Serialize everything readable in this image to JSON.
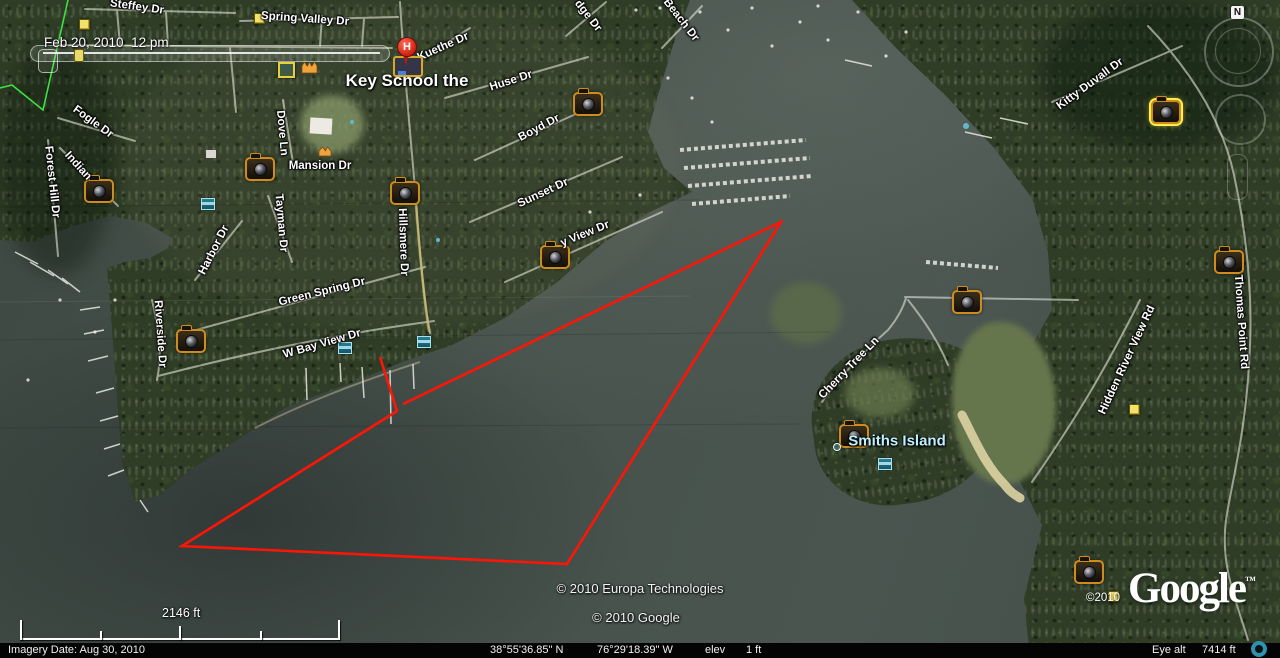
{
  "branding": {
    "logo_text": "Google",
    "tm": "™",
    "watermark": "©2010"
  },
  "time_display": {
    "date_label": "Feb 20, 2010  12 pm"
  },
  "status_bar": {
    "imagery_date": "Imagery Date: Aug 30, 2010",
    "latitude": "38°55'36.85\" N",
    "longitude": "76°29'18.39\" W",
    "elev_label": "elev",
    "elev_value": "1 ft",
    "eye_alt_label": "Eye alt",
    "eye_alt_value": "7414 ft"
  },
  "scale_bar": {
    "distance": "2146 ft"
  },
  "copyrights": {
    "line1": "© 2010 Europa Technologies",
    "line2": "© 2010 Google"
  },
  "compass": {
    "north_label": "N"
  },
  "map": {
    "place_labels": [
      {
        "text": "Key School the",
        "x": 407,
        "y": 81,
        "size": 17,
        "color": "#ffffff"
      },
      {
        "text": "Smiths Island",
        "x": 897,
        "y": 441,
        "size": 15,
        "color": "#bff2ff"
      }
    ],
    "street_labels": [
      {
        "text": "Steffey Dr",
        "x": 137,
        "y": 7,
        "rot": 8
      },
      {
        "text": "Spring Valley Dr",
        "x": 305,
        "y": 19,
        "rot": 4
      },
      {
        "text": "Fogle Dr",
        "x": 93,
        "y": 122,
        "rot": 36
      },
      {
        "text": "Forest Hill Dr",
        "x": 52,
        "y": 182,
        "rot": 84
      },
      {
        "text": "Indian",
        "x": 78,
        "y": 166,
        "rot": 48
      },
      {
        "text": "Dove Ln",
        "x": 282,
        "y": 133,
        "rot": 85
      },
      {
        "text": "Kuethe Dr",
        "x": 443,
        "y": 47,
        "rot": -24
      },
      {
        "text": "Huse Dr",
        "x": 511,
        "y": 81,
        "rot": -18
      },
      {
        "text": "Boyd Dr",
        "x": 539,
        "y": 128,
        "rot": -28
      },
      {
        "text": "Sunset Dr",
        "x": 543,
        "y": 193,
        "rot": -25
      },
      {
        "text": "y View Dr",
        "x": 585,
        "y": 234,
        "rot": -22
      },
      {
        "text": "Mansion Dr",
        "x": 320,
        "y": 166,
        "rot": 0
      },
      {
        "text": "Tayman Dr",
        "x": 281,
        "y": 223,
        "rot": 85
      },
      {
        "text": "Harbor Dr",
        "x": 214,
        "y": 250,
        "rot": -63
      },
      {
        "text": "Green Spring Dr",
        "x": 322,
        "y": 292,
        "rot": -14
      },
      {
        "text": "Hillsmere Dr",
        "x": 403,
        "y": 242,
        "rot": 88
      },
      {
        "text": "Riverside Dr",
        "x": 160,
        "y": 334,
        "rot": 86
      },
      {
        "text": "W Bay View Dr",
        "x": 322,
        "y": 344,
        "rot": -16
      },
      {
        "text": "dge Dr",
        "x": 588,
        "y": 16,
        "rot": 52
      },
      {
        "text": "Beach Dr",
        "x": 681,
        "y": 20,
        "rot": 52
      },
      {
        "text": "Kitty Duvall Dr",
        "x": 1090,
        "y": 84,
        "rot": -36
      },
      {
        "text": "Thomas Point Rd",
        "x": 1241,
        "y": 322,
        "rot": 86
      },
      {
        "text": "Hidden River View Rd",
        "x": 1127,
        "y": 360,
        "rot": -65
      },
      {
        "text": "Cherry Tree Ln",
        "x": 849,
        "y": 368,
        "rot": -46
      }
    ],
    "photo_cameras": [
      {
        "x": 97,
        "y": 189
      },
      {
        "x": 258,
        "y": 167
      },
      {
        "x": 403,
        "y": 191
      },
      {
        "x": 586,
        "y": 102
      },
      {
        "x": 553,
        "y": 255
      },
      {
        "x": 189,
        "y": 339
      },
      {
        "x": 852,
        "y": 434
      },
      {
        "x": 965,
        "y": 300
      },
      {
        "x": 1164,
        "y": 110,
        "selected": true
      },
      {
        "x": 1227,
        "y": 260
      },
      {
        "x": 1087,
        "y": 570
      }
    ],
    "yellow_placemarks": [
      {
        "x": 83,
        "y": 23
      },
      {
        "x": 258,
        "y": 17
      },
      {
        "x": 1133,
        "y": 408
      },
      {
        "x": 1112,
        "y": 595
      }
    ],
    "photo_frame_placemark": {
      "x": 284,
      "y": 68
    },
    "blue_photo_markers": [
      {
        "x": 207,
        "y": 203
      },
      {
        "x": 344,
        "y": 347
      },
      {
        "x": 423,
        "y": 341
      },
      {
        "x": 884,
        "y": 463
      }
    ],
    "orange_icons": [
      {
        "x": 309,
        "y": 67,
        "spires": 3
      },
      {
        "x": 326,
        "y": 152,
        "spires": 2
      }
    ],
    "island_dot": {
      "x": 836,
      "y": 446
    },
    "school_marker": {
      "letter": "H"
    }
  },
  "overlays": {
    "red_path": {
      "color": "#fe1506",
      "points": [
        [
          380,
          357
        ],
        [
          397,
          411
        ],
        [
          182,
          546
        ],
        [
          567,
          564
        ],
        [
          781,
          222
        ],
        [
          403,
          404
        ]
      ]
    },
    "green_track": {
      "color": "#3ce341",
      "points": [
        [
          68,
          0
        ],
        [
          43,
          110
        ],
        [
          12,
          85
        ],
        [
          0,
          88
        ]
      ]
    }
  }
}
